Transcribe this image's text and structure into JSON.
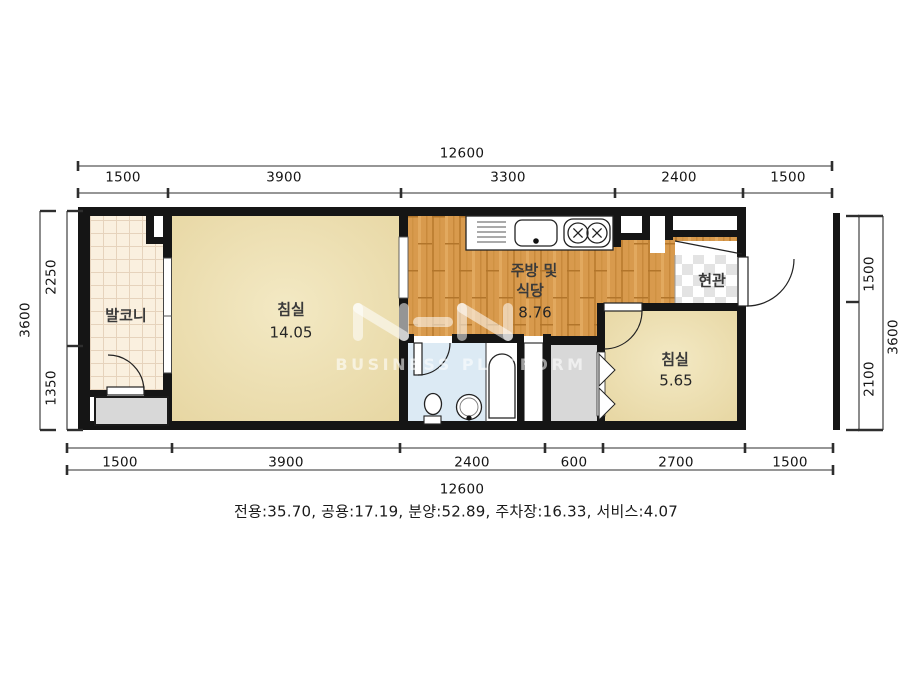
{
  "floor_plan": {
    "dim_top": {
      "total": "12600",
      "segments": [
        "1500",
        "3900",
        "3300",
        "2400",
        "1500"
      ]
    },
    "dim_bottom": {
      "total": "12600",
      "segments": [
        "1500",
        "3900",
        "2400",
        "600",
        "2700",
        "1500"
      ]
    },
    "dim_left": {
      "total": "3600",
      "segments": [
        "2250",
        "1350"
      ]
    },
    "dim_right": {
      "total": "3600",
      "segments": [
        "1500",
        "2100"
      ]
    },
    "rooms": {
      "balcony": {
        "label": "발코니"
      },
      "bedroom_main": {
        "label": "침실",
        "area": "14.05"
      },
      "kitchen_dining": {
        "label_line1": "주방 및",
        "label_line2": "식당",
        "area": "8.76"
      },
      "entrance": {
        "label": "현관"
      },
      "bedroom_small": {
        "label": "침실",
        "area": "5.65"
      }
    },
    "area_summary": "전용:35.70, 공용:17.19, 분양:52.89, 주차장:16.33, 서비스:4.07",
    "watermark": {
      "logo": "N-N",
      "text": "BUSINESS PLATFORM"
    },
    "colors": {
      "wall": "#151515",
      "bedroom_floor": "#e7d7a3",
      "kitchen_floor": "#d89a4d",
      "balcony_floor": "#faf0df",
      "bathroom_floor": "#dceaf4",
      "service_gray": "#d8d8d8",
      "entrance_tile": "#e3e3e3"
    }
  }
}
